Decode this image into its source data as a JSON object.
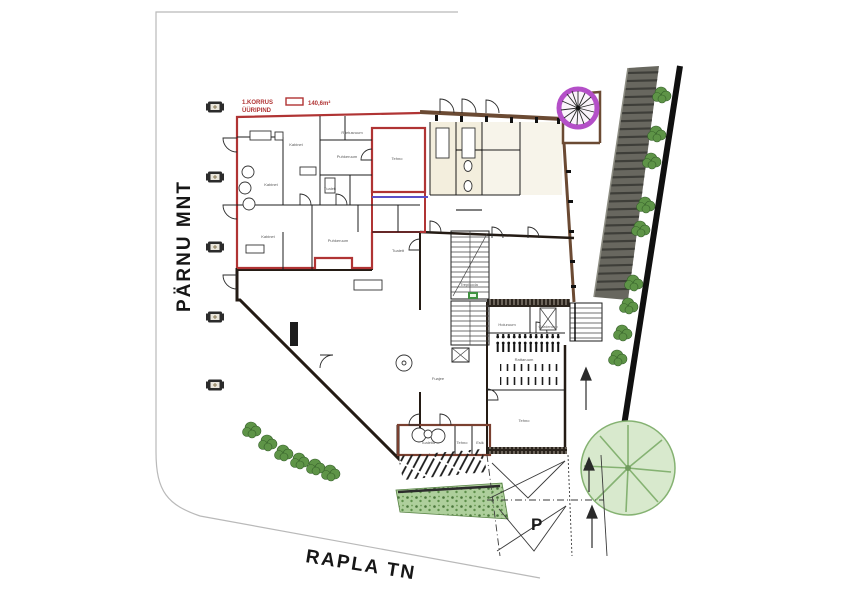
{
  "drawing": {
    "type": "architectural-site-plan",
    "floor": "1. korrus (first floor) site plan with leased area highlighted"
  },
  "streets": {
    "left": "PÄRNU MNT",
    "bottom": "RAPLA TN"
  },
  "legend": {
    "title_line1": "1.KORRUS",
    "title_line2": "ÜÜRIPIND",
    "area_value": "140,6m²"
  },
  "parking": {
    "label": "P"
  },
  "plan": {
    "rooms": [
      {
        "label": "Kabinet",
        "x": 296,
        "y": 146
      },
      {
        "label": "Riietusruum",
        "x": 352,
        "y": 134
      },
      {
        "label": "Puhkeruum",
        "x": 347,
        "y": 158
      },
      {
        "label": "Kabinet",
        "x": 271,
        "y": 186
      },
      {
        "label": "Tualett",
        "x": 330,
        "y": 190
      },
      {
        "label": "Tehno",
        "x": 397,
        "y": 160
      },
      {
        "label": "Kabinet",
        "x": 268,
        "y": 238
      },
      {
        "label": "Puhkeruum",
        "x": 338,
        "y": 242
      },
      {
        "label": "Tualett",
        "x": 398,
        "y": 252
      },
      {
        "label": "Trepikoda",
        "x": 469,
        "y": 286
      },
      {
        "label": "Fuajee",
        "x": 438,
        "y": 380
      },
      {
        "label": "Hoiuruum",
        "x": 507,
        "y": 326
      },
      {
        "label": "Garderoob",
        "x": 548,
        "y": 328
      },
      {
        "label": "Rattaruum",
        "x": 524,
        "y": 361
      },
      {
        "label": "Tehno",
        "x": 524,
        "y": 422
      },
      {
        "label": "Tualetid",
        "x": 428,
        "y": 444
      },
      {
        "label": "Tehno",
        "x": 462,
        "y": 444
      },
      {
        "label": "Esik",
        "x": 480,
        "y": 444
      }
    ]
  },
  "colors": {
    "lease_outline": "#b03434",
    "wall": "#241b14",
    "wall_brown": "#6b4a33",
    "maroon": "#7a4030",
    "ramp": "#68675f",
    "ramp_rib": "#3e3e39",
    "boundary": "#101010",
    "bush": "#5e9447",
    "tree_fill": "#d8e9cd",
    "tree_stroke": "#85b272",
    "spiral_ring": "#b44fc8",
    "site_line": "#b9b9b9",
    "purple_line": "#5a50c8",
    "beige": "#f3eedd",
    "exit_sign": "#3f9140"
  }
}
